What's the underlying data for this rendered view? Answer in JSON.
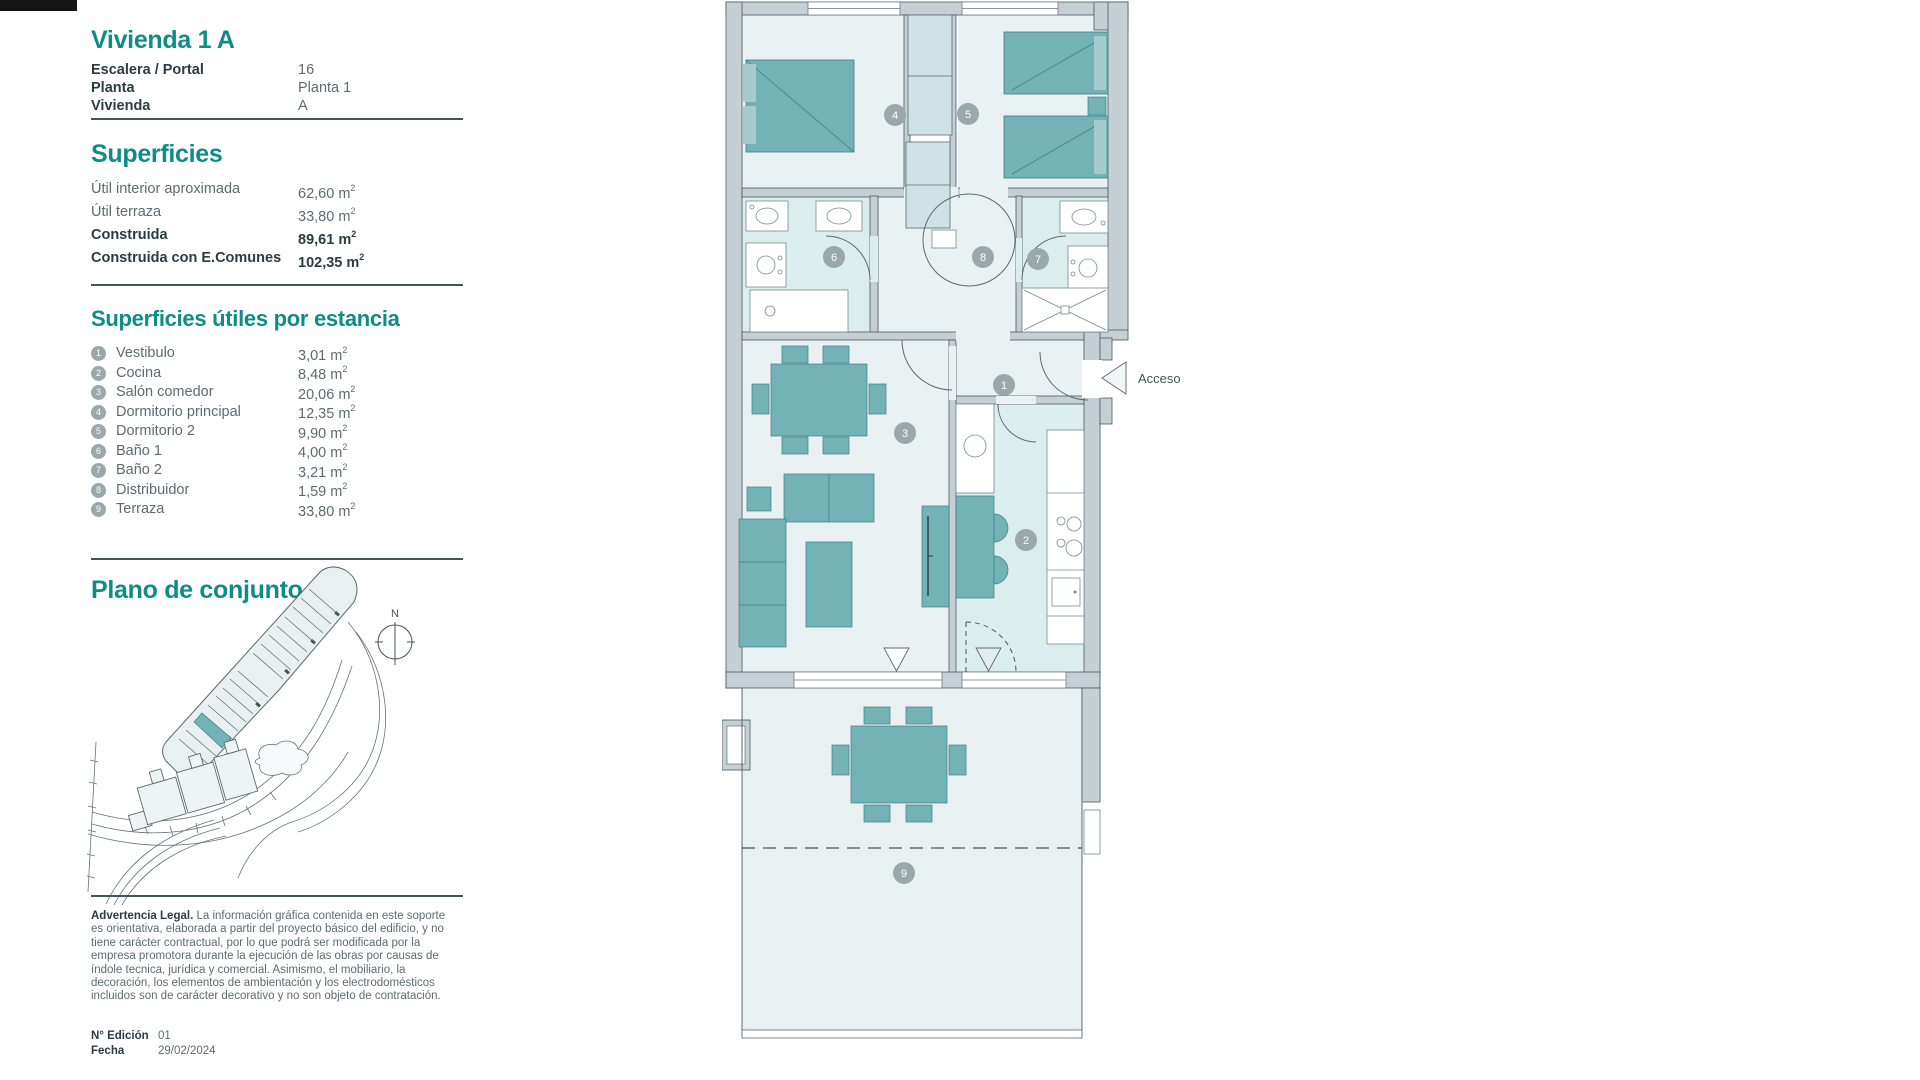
{
  "colors": {
    "accent": "#0e8c85",
    "furniture_teal": "#74b3b5",
    "floor_light": "#e9f1f2",
    "floor_wet": "#dcedee",
    "wall_gray": "#c6cfd3",
    "badge_gray": "#9aa7ab"
  },
  "units": {
    "base": "m",
    "exponent": "2"
  },
  "sidebar": {
    "title": "Vivienda 1 A",
    "details": [
      {
        "label": "Escalera / Portal",
        "value": "16"
      },
      {
        "label": "Planta",
        "value": "Planta 1"
      },
      {
        "label": "Vivienda",
        "value": "A"
      }
    ],
    "superficies": {
      "heading": "Superficies",
      "rows": [
        {
          "label": "Útil interior aproximada",
          "value": "62,60"
        },
        {
          "label": "Útil terraza",
          "value": "33,80"
        }
      ],
      "rows_bold": [
        {
          "label": "Construida",
          "value": "89,61"
        },
        {
          "label": "Construida con E.Comunes",
          "value": "102,35"
        }
      ]
    },
    "rooms": {
      "heading": "Superficies útiles por estancia",
      "items": [
        {
          "num": "1",
          "label": "Vestibulo",
          "value": "3,01"
        },
        {
          "num": "2",
          "label": "Cocina",
          "value": "8,48"
        },
        {
          "num": "3",
          "label": "Salón comedor",
          "value": "20,06"
        },
        {
          "num": "4",
          "label": "Dormitorio principal",
          "value": "12,35"
        },
        {
          "num": "5",
          "label": "Dormitorio 2",
          "value": "9,90"
        },
        {
          "num": "6",
          "label": "Baño 1",
          "value": "4,00"
        },
        {
          "num": "7",
          "label": "Baño 2",
          "value": "3,21"
        },
        {
          "num": "8",
          "label": "Distribuidor",
          "value": "1,59"
        },
        {
          "num": "9",
          "label": "Terraza",
          "value": "33,80"
        }
      ]
    },
    "site": {
      "heading": "Plano de conjunto",
      "compass": "N"
    },
    "legal": {
      "title": "Advertencia Legal.",
      "body": " La información gráfica contenida en este soporte es orientativa, elaborada a partir del proyecto básico del edificio, y no tiene carácter contractual, por lo que podrá ser modificada por la empresa promotora durante la ejecución de las obras por causas de índole tecnica, jurídica y comercial. Asimismo, el mobiliario, la decoración, los elementos de ambientación y los electrodomésticos incluidos son de carácter decorativo y no son objeto de contratación."
    },
    "edition": [
      {
        "label": "N° Edición",
        "value": "01"
      },
      {
        "label": "Fecha",
        "value": "29/02/2024"
      }
    ]
  },
  "plan": {
    "access_label": "Acceso",
    "badges": [
      "1",
      "2",
      "3",
      "4",
      "5",
      "6",
      "7",
      "8",
      "9"
    ]
  }
}
